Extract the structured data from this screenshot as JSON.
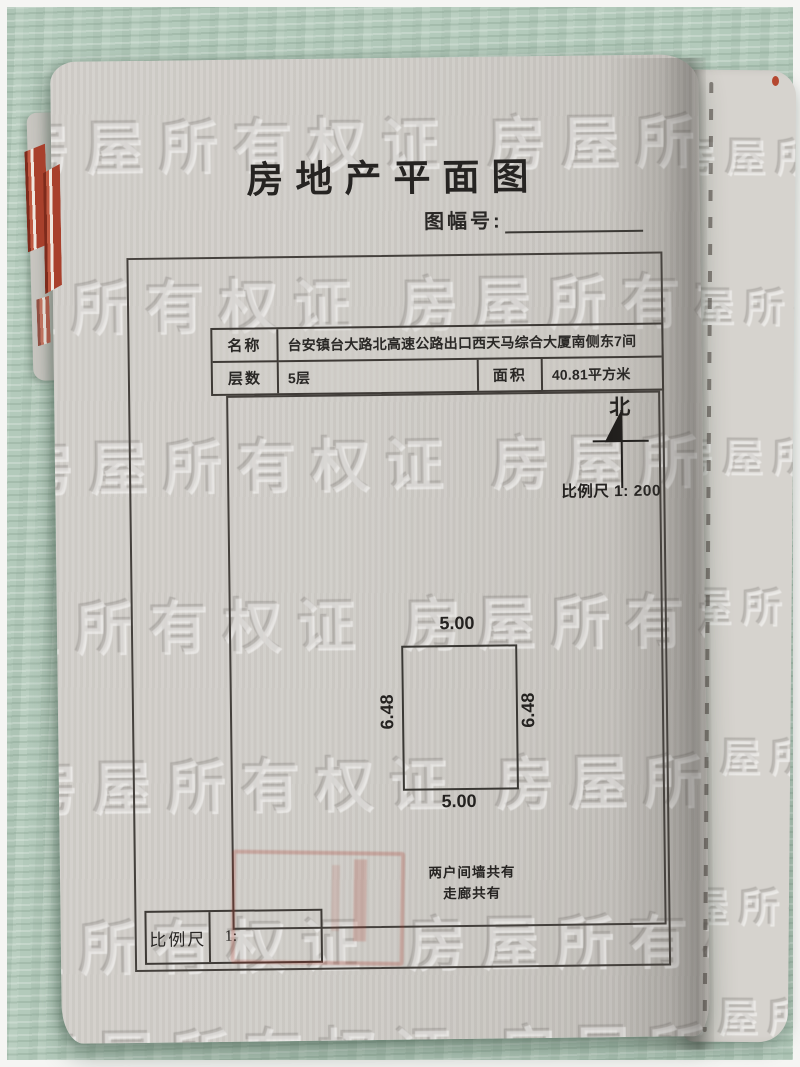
{
  "title": "房地产平面图",
  "sheet": {
    "label": "图幅号:"
  },
  "info_table": {
    "name_label": "名称",
    "name_value": "台安镇台大路北高速公路出口西天马综合大厦南侧东7间",
    "floors_label": "层数",
    "floors_value": "5层",
    "area_label": "面积",
    "area_value": "40.81平方米"
  },
  "compass": {
    "north": "北",
    "scale": "比例尺 1: 200"
  },
  "plan": {
    "top": "5.00",
    "bottom": "5.00",
    "left": "6.48",
    "right": "6.48"
  },
  "notes": {
    "line1": "两户间墙共有",
    "line2": "走廊共有"
  },
  "scale_box": {
    "label": "比例尺",
    "value": "1:"
  },
  "watermark": {
    "row": "房屋所有权证 房屋所有权证 房屋所有权证"
  },
  "colors": {
    "felt_green": "#b6ccbe",
    "paper": "#d0cdc8",
    "ink": "#2a2826",
    "seal_red": "#a8402c"
  }
}
